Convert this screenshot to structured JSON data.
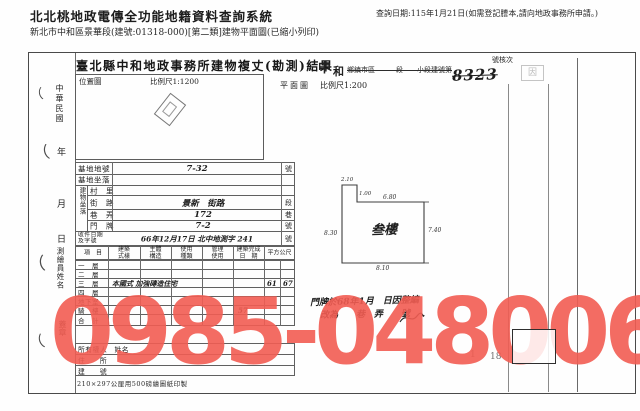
{
  "header": {
    "system_title": "北北桃地政電傳全功能地籍資料查詢系統",
    "subtitle": "新北市中和區景華段(建號:01318-000)[第二類]建物平面圖(已縮小列印)",
    "query_date": "查詢日期:115年1月21日(如需登記謄本,請向地政事務所申請。)"
  },
  "form": {
    "title": "臺北縣中和地政事務所建物複丈(勘測)結果",
    "county_char": "中",
    "township_char": "和",
    "section_line": "鄉鎮市區　　　段　　小段建號第",
    "building_no": "8323",
    "check_label": "號核次",
    "stamp_char": "因",
    "location_map": {
      "label": "位置圖",
      "scale": "比例尺1:1200"
    },
    "plan": {
      "label": "平面圖",
      "scale": "比例尺1:200",
      "room": "叁樓",
      "dim_top_notch": "2.10",
      "dim_notch": "1.00",
      "dim_top": "6.80",
      "dim_left": "8.30",
      "dim_right": "7.40",
      "dim_bottom": "8.10"
    },
    "margin": {
      "era": "中華民國",
      "year": "年",
      "month": "月",
      "day": "日",
      "surveyor": "測繪員姓名",
      "seal": "蓋章",
      "marks": [
        "（",
        "（",
        "（",
        "（"
      ]
    },
    "site_rows": [
      {
        "label": "基地地號",
        "value": "7-32",
        "suffix": "號"
      },
      {
        "label": "基地坐落",
        "value": "",
        "suffix": ""
      }
    ],
    "addr_group": "建物坐落",
    "addr_rows": [
      {
        "label": "村　里",
        "value": "",
        "suffix": ""
      },
      {
        "label": "街　路",
        "value": "景新　街路",
        "suffix": "段"
      },
      {
        "label": "巷　弄",
        "value": "172",
        "suffix": "巷"
      },
      {
        "label": "門　牌",
        "value": "7-2",
        "suffix": "號"
      }
    ],
    "receipt": {
      "label": "收件日期\n及字號",
      "value": "66年12月17日 北中地測字 241",
      "suffix": "號"
    },
    "floor": {
      "headers": [
        "項　目",
        "建築\n式樣",
        "主體\n構造",
        "使用\n種類",
        "管理\n使用",
        "建築完成\n日　期",
        "平方公尺"
      ],
      "rows": [
        {
          "label": "一　層",
          "entry": ""
        },
        {
          "label": "二　層",
          "entry": ""
        },
        {
          "label": "三　層",
          "entry": "本國式 加強磚造住宅",
          "a": "61",
          "b": "67"
        },
        {
          "label": "四　層",
          "entry": ""
        },
        {
          "label": "地下室",
          "entry": ""
        },
        {
          "label": "騎　樓",
          "entry": ""
        },
        {
          "label": "合　計",
          "entry": ""
        }
      ],
      "total": "57"
    },
    "owner_rows": [
      {
        "label": "所有權人　姓名"
      },
      {
        "label": "住　　所"
      },
      {
        "label": "建　　號"
      }
    ],
    "print_note": "210×297公厘用500磅繪圖紙印製",
    "annotation": {
      "line1": "門牌於68年1月　日因整編",
      "line2": "改為　　巷　弄　　號"
    },
    "page_num_a": "1",
    "page_num_b": "18"
  },
  "watermark": {
    "text": "0985-048006",
    "color": "#f25d53"
  }
}
